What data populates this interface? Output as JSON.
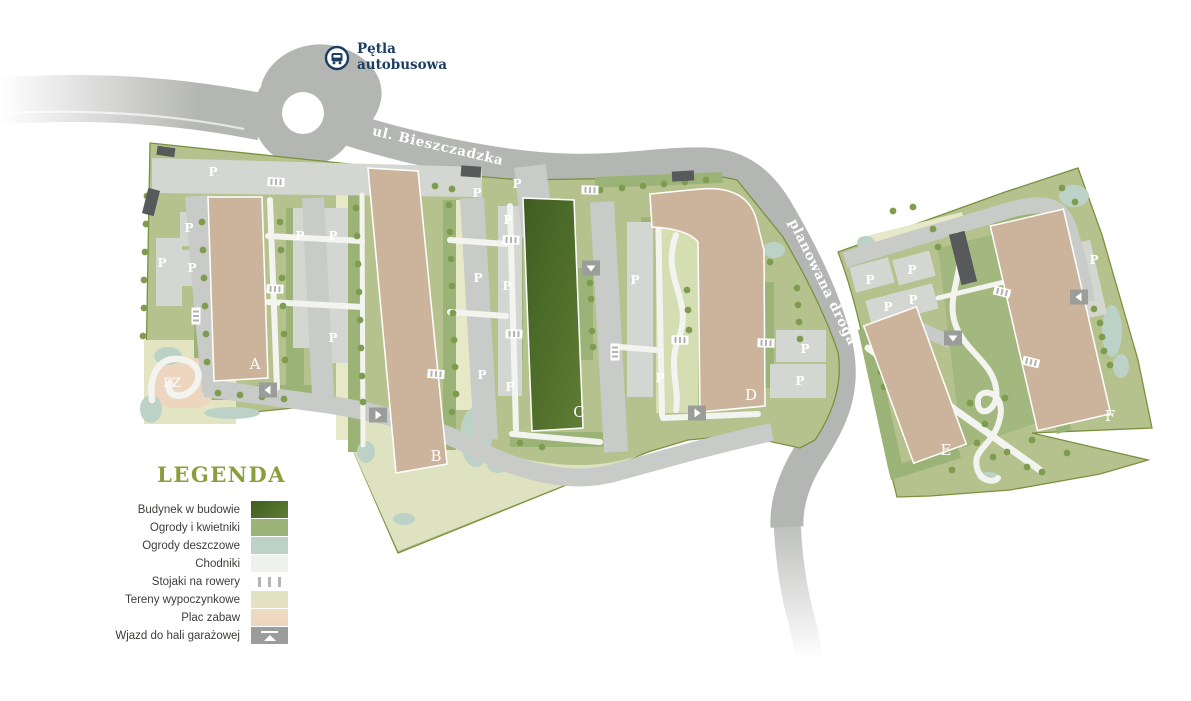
{
  "colors": {
    "site_green": "#b6c28e",
    "gardens": "#9cb377",
    "rain_garden": "#bdd2c7",
    "tree": "#7e9c4f",
    "paths_white": "#f3f4f0",
    "construction_dark": "#3f5d20",
    "construction_light": "#5f7d34",
    "building_tan": "#cbb49b",
    "road_gray": "#b4b6b3",
    "inner_road": "#c9cbc8",
    "parking": "#d4d6d2",
    "leisure_cream": "#e2e4c2",
    "playground_pink": "#eed5c0",
    "garage_gray": "#9b9d9a",
    "navy": "#1c3e63",
    "legend_title": "#8a9e3e",
    "boundary": "#7d9040"
  },
  "map": {
    "bus_stop": {
      "icon": "bus-icon",
      "lines": [
        "Pętla",
        "autobusowa"
      ],
      "x": 357,
      "y1": 53,
      "y2": 69,
      "cx": 337,
      "cy": 58
    },
    "streets": [
      {
        "name": "ul. Bieszczadzka",
        "x": 437,
        "y": 150,
        "angle": 13
      },
      {
        "name": "planowana droga",
        "x": 819,
        "y": 284,
        "angle": 64
      }
    ],
    "building_labels": [
      {
        "t": "A",
        "x": 255,
        "y": 369
      },
      {
        "t": "B",
        "x": 436,
        "y": 461
      },
      {
        "t": "C",
        "x": 579,
        "y": 417
      },
      {
        "t": "D",
        "x": 751,
        "y": 400
      },
      {
        "t": "E",
        "x": 946,
        "y": 455
      },
      {
        "t": "F",
        "x": 1110,
        "y": 421
      }
    ],
    "playground_label": {
      "t": "PZ",
      "x": 172,
      "y": 387
    },
    "parking_letter": "P",
    "parking_markers": [
      [
        213,
        172
      ],
      [
        189,
        228
      ],
      [
        162,
        263
      ],
      [
        192,
        268
      ],
      [
        300,
        236
      ],
      [
        333,
        236
      ],
      [
        333,
        338
      ],
      [
        477,
        193
      ],
      [
        517,
        184
      ],
      [
        508,
        220
      ],
      [
        478,
        278
      ],
      [
        507,
        286
      ],
      [
        482,
        375
      ],
      [
        510,
        387
      ],
      [
        635,
        280
      ],
      [
        660,
        378
      ],
      [
        805,
        349
      ],
      [
        800,
        381
      ],
      [
        870,
        280
      ],
      [
        912,
        270
      ],
      [
        888,
        307
      ],
      [
        913,
        300
      ],
      [
        1094,
        260
      ]
    ],
    "trees": [
      [
        147,
        196
      ],
      [
        146,
        224
      ],
      [
        145,
        252
      ],
      [
        144,
        280
      ],
      [
        144,
        308
      ],
      [
        143,
        336
      ],
      [
        202,
        222
      ],
      [
        203,
        250
      ],
      [
        204,
        278
      ],
      [
        205,
        306
      ],
      [
        206,
        334
      ],
      [
        207,
        362
      ],
      [
        280,
        222
      ],
      [
        281,
        250
      ],
      [
        282,
        278
      ],
      [
        283,
        306
      ],
      [
        284,
        334
      ],
      [
        285,
        360
      ],
      [
        218,
        393
      ],
      [
        240,
        395
      ],
      [
        262,
        397
      ],
      [
        284,
        399
      ],
      [
        356,
        208
      ],
      [
        357,
        236
      ],
      [
        358,
        264
      ],
      [
        359,
        292
      ],
      [
        360,
        320
      ],
      [
        361,
        348
      ],
      [
        362,
        376
      ],
      [
        363,
        402
      ],
      [
        449,
        205
      ],
      [
        450,
        232
      ],
      [
        451,
        259
      ],
      [
        452,
        286
      ],
      [
        453,
        313
      ],
      [
        454,
        340
      ],
      [
        455,
        367
      ],
      [
        456,
        394
      ],
      [
        452,
        412
      ],
      [
        435,
        186
      ],
      [
        452,
        189
      ],
      [
        600,
        190
      ],
      [
        622,
        188
      ],
      [
        643,
        186
      ],
      [
        664,
        184
      ],
      [
        685,
        182
      ],
      [
        706,
        180
      ],
      [
        590,
        283
      ],
      [
        591,
        299
      ],
      [
        592,
        331
      ],
      [
        593,
        347
      ],
      [
        520,
        443
      ],
      [
        542,
        447
      ],
      [
        687,
        290
      ],
      [
        688,
        310
      ],
      [
        689,
        330
      ],
      [
        797,
        288
      ],
      [
        798,
        305
      ],
      [
        799,
        322
      ],
      [
        800,
        339
      ],
      [
        770,
        262
      ],
      [
        893,
        211
      ],
      [
        913,
        207
      ],
      [
        933,
        229
      ],
      [
        938,
        247
      ],
      [
        873,
        342
      ],
      [
        878,
        357
      ],
      [
        881,
        372
      ],
      [
        884,
        387
      ],
      [
        970,
        403
      ],
      [
        985,
        424
      ],
      [
        977,
        443
      ],
      [
        1007,
        452
      ],
      [
        993,
        457
      ],
      [
        1027,
        467
      ],
      [
        1042,
        472
      ],
      [
        1067,
        453
      ],
      [
        1005,
        398
      ],
      [
        1032,
        440
      ],
      [
        952,
        470
      ],
      [
        1094,
        309
      ],
      [
        1100,
        323
      ],
      [
        1102,
        337
      ],
      [
        1104,
        351
      ],
      [
        1110,
        365
      ],
      [
        1062,
        188
      ],
      [
        1075,
        202
      ]
    ],
    "rain_gardens": [
      [
        168,
        356,
        14,
        9
      ],
      [
        151,
        409,
        11,
        14
      ],
      [
        232,
        413,
        28,
        6
      ],
      [
        476,
        437,
        16,
        30
      ],
      [
        366,
        452,
        9,
        11
      ],
      [
        404,
        519,
        11,
        6
      ],
      [
        498,
        464,
        11,
        9
      ],
      [
        774,
        250,
        11,
        8
      ],
      [
        866,
        243,
        9,
        7
      ],
      [
        1074,
        196,
        15,
        11
      ],
      [
        1112,
        331,
        10,
        26
      ],
      [
        1121,
        366,
        8,
        12
      ],
      [
        988,
        477,
        11,
        5
      ]
    ],
    "bike_racks": [
      [
        276,
        182,
        3
      ],
      [
        275,
        289,
        2
      ],
      [
        196,
        316,
        90
      ],
      [
        436,
        374,
        4
      ],
      [
        590,
        190,
        2
      ],
      [
        511,
        240,
        2
      ],
      [
        514,
        334,
        2
      ],
      [
        615,
        352,
        90
      ],
      [
        680,
        340,
        2
      ],
      [
        766,
        343,
        2
      ],
      [
        1002,
        292,
        14
      ],
      [
        1031,
        362,
        14
      ]
    ],
    "garage_entrances": [
      [
        268,
        390,
        "left"
      ],
      [
        378,
        415,
        "right"
      ],
      [
        591,
        268,
        "down"
      ],
      [
        697,
        413,
        "right"
      ],
      [
        953,
        338,
        "down"
      ],
      [
        1079,
        297,
        "left"
      ]
    ]
  },
  "legend": {
    "title": "LEGENDA",
    "items": [
      {
        "label": "Budynek w budowie",
        "swatch": "construction"
      },
      {
        "label": "Ogrody i kwietniki",
        "swatch": "gardens"
      },
      {
        "label": "Ogrody deszczowe",
        "swatch": "rain"
      },
      {
        "label": "Chodniki",
        "swatch": "paths"
      },
      {
        "label": "Stojaki na rowery",
        "swatch": "bikes"
      },
      {
        "label": "Tereny wypoczynkowe",
        "swatch": "leisure"
      },
      {
        "label": "Plac zabaw",
        "swatch": "playground"
      },
      {
        "label": "Wjazd do hali garażowej",
        "swatch": "garage"
      }
    ]
  }
}
